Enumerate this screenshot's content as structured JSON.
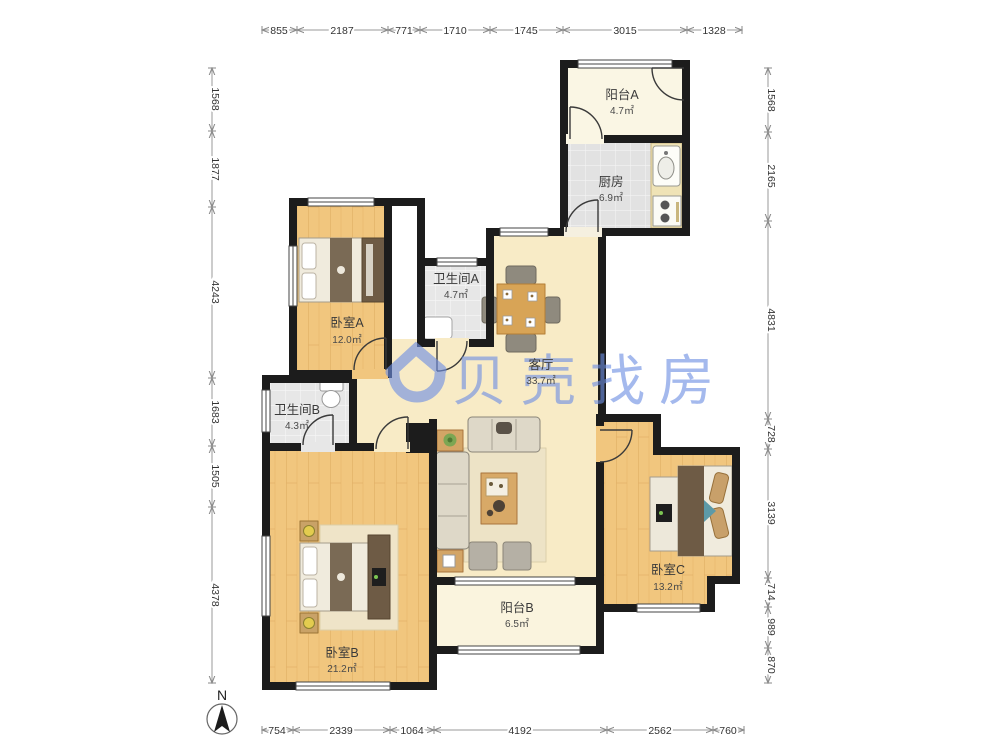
{
  "watermark": {
    "text": "贝壳找房",
    "color": "#6e8fe3"
  },
  "compass": {
    "label": "N"
  },
  "rooms": [
    {
      "id": "balcony-a",
      "name": "阳台A",
      "area": "4.7㎡"
    },
    {
      "id": "kitchen",
      "name": "厨房",
      "area": "6.9㎡"
    },
    {
      "id": "bathroom-a",
      "name": "卫生间A",
      "area": "4.7㎡"
    },
    {
      "id": "bedroom-a",
      "name": "卧室A",
      "area": "12.0㎡"
    },
    {
      "id": "living-room",
      "name": "客厅",
      "area": "33.7㎡"
    },
    {
      "id": "bathroom-b",
      "name": "卫生间B",
      "area": "4.3㎡"
    },
    {
      "id": "bedroom-b",
      "name": "卧室B",
      "area": "21.2㎡"
    },
    {
      "id": "balcony-b",
      "name": "阳台B",
      "area": "6.5㎡"
    },
    {
      "id": "bedroom-c",
      "name": "卧室C",
      "area": "13.2㎡"
    }
  ],
  "dims": {
    "top": [
      "855",
      "2187",
      "771",
      "1710",
      "1745",
      "3015",
      "1328"
    ],
    "bottom": [
      "754",
      "2339",
      "1064",
      "4192",
      "2562",
      "760"
    ],
    "left": [
      "1568",
      "1877",
      "4243",
      "1683",
      "1505",
      "4378"
    ],
    "right": [
      "1568",
      "2165",
      "4831",
      "728",
      "3139",
      "714",
      "989",
      "870"
    ]
  },
  "colors": {
    "wall": "#1c1c1c",
    "wood_floor": "#F1C67E",
    "living_floor": "#F8EBC6",
    "tile_floor": "#E3E3E3",
    "balcony_floor": "#FAF6E4"
  }
}
